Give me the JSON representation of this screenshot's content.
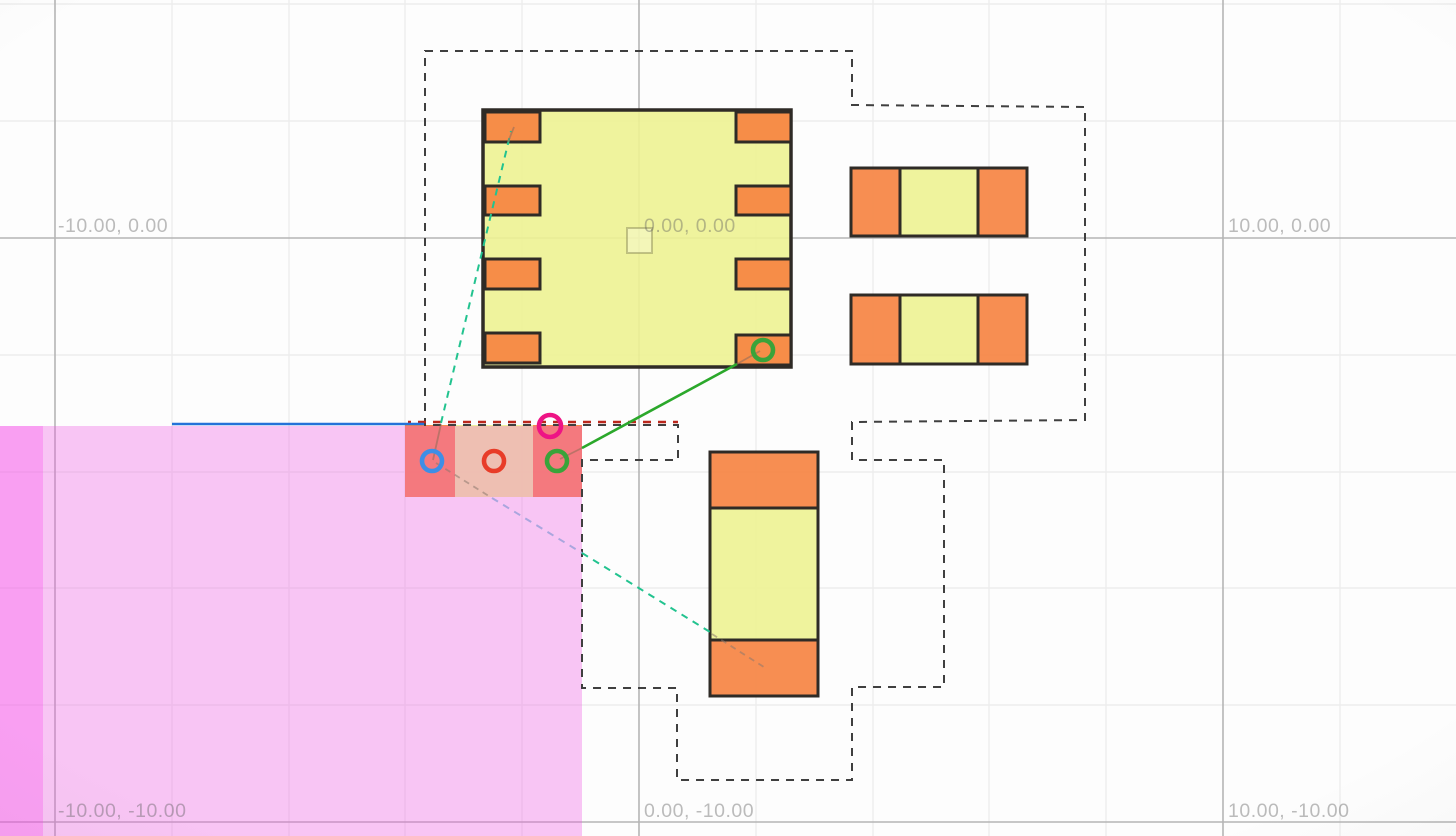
{
  "labels": {
    "items": [
      {
        "text": "-10.00, 0.00"
      },
      {
        "text": "0.00, 0.00"
      },
      {
        "text": "10.00, 0.00"
      },
      {
        "text": "-10.00, -10.00"
      },
      {
        "text": "0.00, -10.00"
      },
      {
        "text": "10.00, -10.00"
      }
    ]
  },
  "colors": {
    "body": "#edf292",
    "pad": "#f6823f",
    "zone": "#ee50e4",
    "zone_strip": "#fa3cee",
    "courtyard": "#3f3f3f",
    "courtyard_red": "#bb271c",
    "ratsnest_teal": "#22c38f",
    "ratsnest_lavender": "#aaa6de",
    "net_blue": "#2472d9",
    "net_green": "#2ba82b"
  },
  "markers": {
    "blue": "#3e8ee6",
    "red": "#e83c28",
    "green": "#3aa33a",
    "magenta": "#ee1485",
    "pad_green": "#3aa33a"
  }
}
